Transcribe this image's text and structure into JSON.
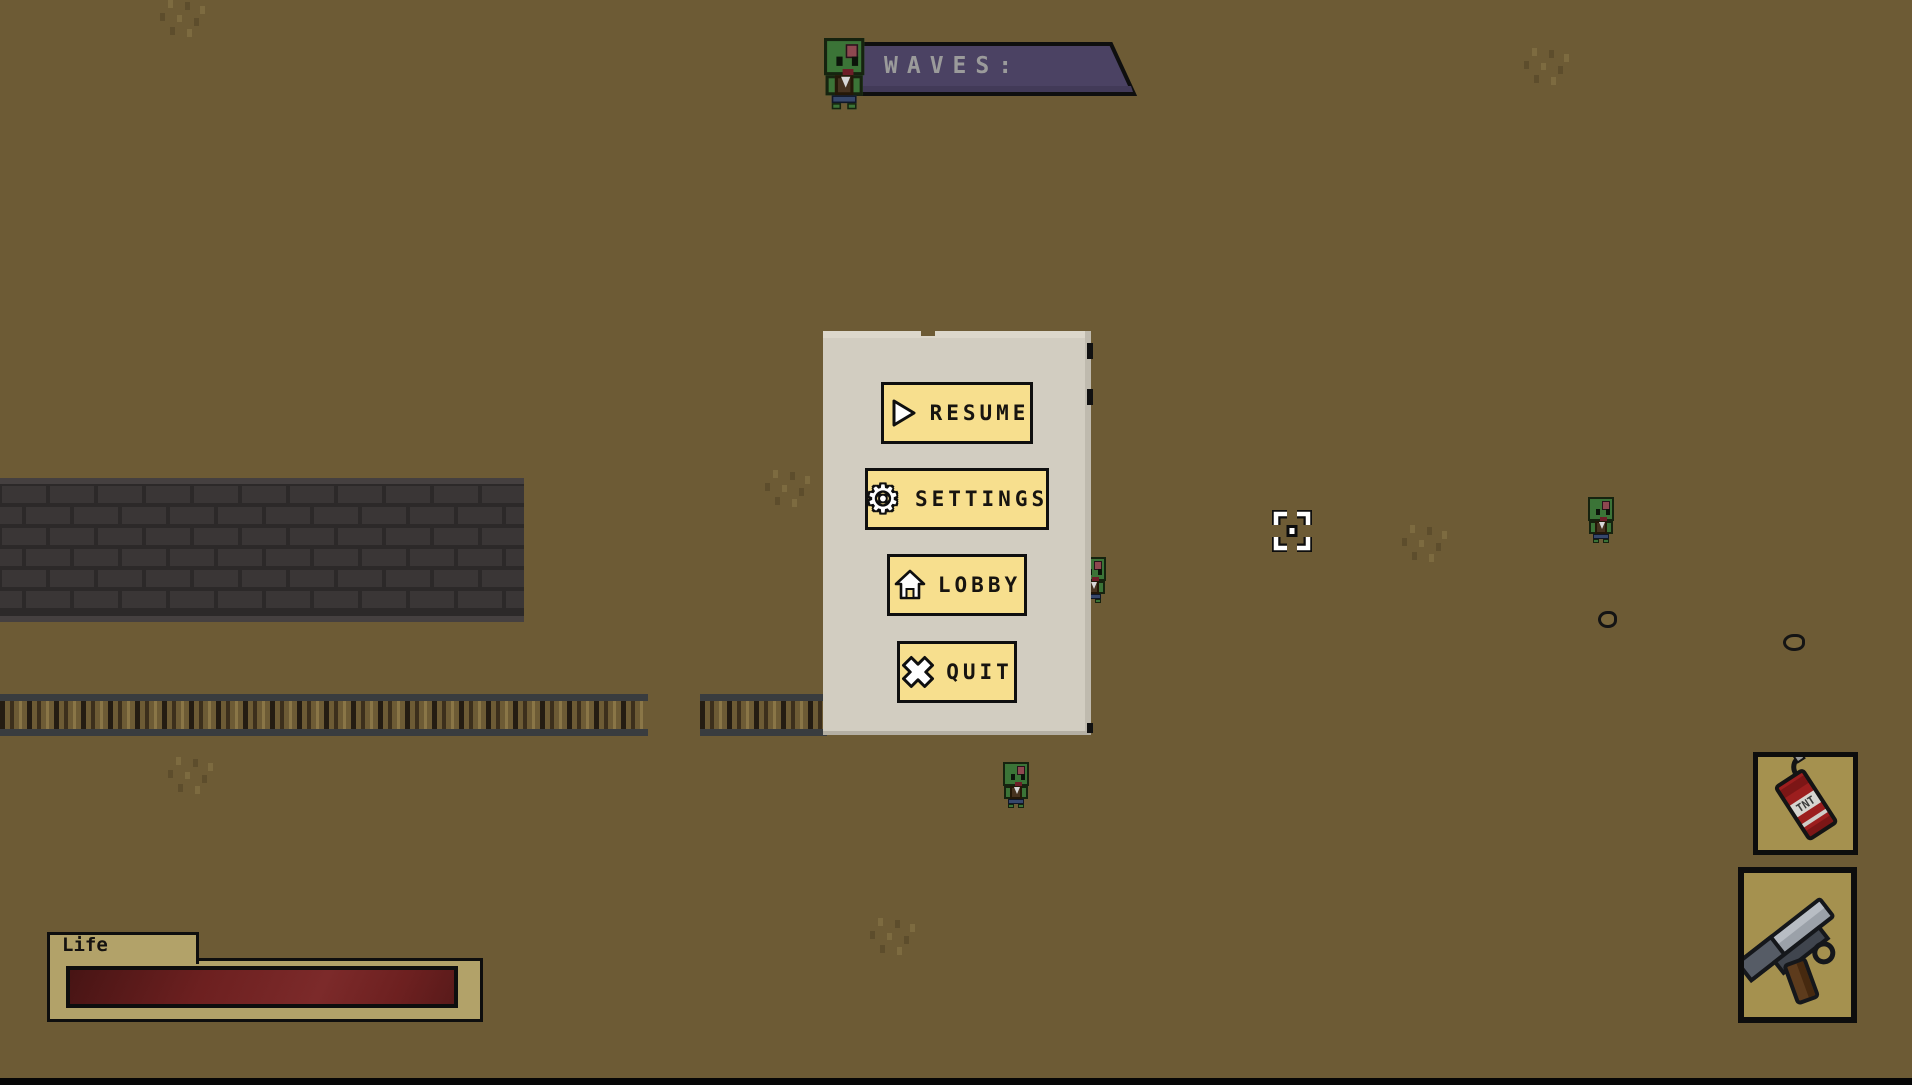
{
  "hud": {
    "waves_banner": {
      "label": "WAVES:"
    },
    "life_panel": {
      "label": "Life",
      "health_percent": 100
    },
    "inventory": {
      "tnt_label": "TNT",
      "slot1_item": "dynamite",
      "slot2_item": "revolver"
    },
    "crosshair": "target-reticle"
  },
  "pause_menu": {
    "gear_glyph": "⚙",
    "buttons": [
      {
        "id": "resume",
        "label": "RESUME",
        "icon": "play-icon"
      },
      {
        "id": "settings",
        "label": "SETTINGS",
        "icon": "gear-icon"
      },
      {
        "id": "lobby",
        "label": "LOBBY",
        "icon": "home-icon"
      },
      {
        "id": "quit",
        "label": "QUIT",
        "icon": "x-icon"
      }
    ]
  },
  "colors": {
    "background": "#6d5b35",
    "banner": "#4b4263",
    "panel": "#d2cdc1",
    "button": "#f7df8e",
    "health_bar": "#6f2121",
    "wall_brick": "#3a3636",
    "banner_text": "#9b9b9b"
  }
}
